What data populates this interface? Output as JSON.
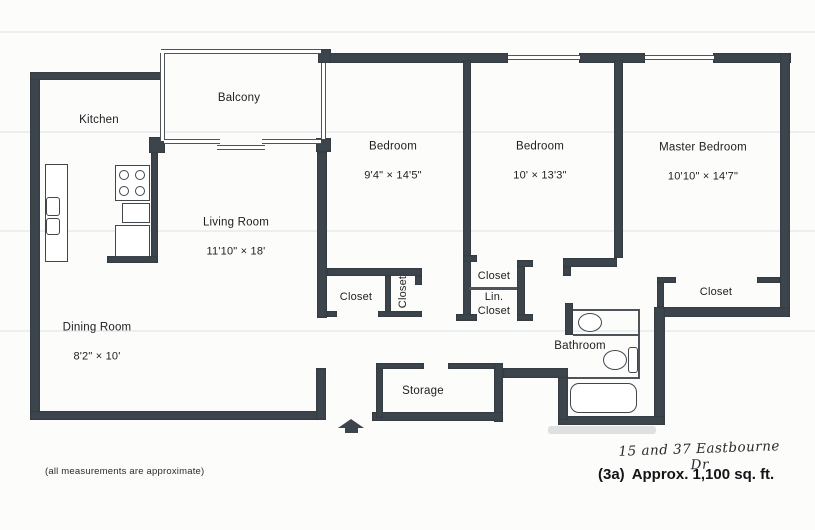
{
  "colors": {
    "wall": "#3d454c",
    "line": "#4e545a",
    "fixture": "#41464c",
    "text": "#1d1e20",
    "paper": "#fcfcfb"
  },
  "rooms": {
    "kitchen": {
      "name": "Kitchen"
    },
    "balcony": {
      "name": "Balcony"
    },
    "living_room": {
      "name": "Living Room",
      "dims": "11'10\" × 18'"
    },
    "dining_room": {
      "name": "Dining Room",
      "dims": "8'2\" × 10'"
    },
    "bedroom1": {
      "name": "Bedroom",
      "dims": "9'4\" × 14'5\""
    },
    "bedroom2": {
      "name": "Bedroom",
      "dims": "10' × 13'3\""
    },
    "master_bedroom": {
      "name": "Master Bedroom",
      "dims": "10'10\" × 14'7\""
    },
    "bathroom": {
      "name": "Bathroom"
    },
    "storage": {
      "name": "Storage"
    },
    "closet_living": {
      "name": "Closet"
    },
    "closet_bedroom1": {
      "name": "Closet"
    },
    "closet_bedroom2": {
      "name": "Closet"
    },
    "linen_closet": {
      "name": "Lin.\nCloset"
    },
    "closet_master": {
      "name": "Closet"
    }
  },
  "footer": {
    "note": "(all measurements are approximate)",
    "plan_id": "(3a)",
    "area": "Approx. 1,100 sq. ft.",
    "handwritten": "15 and 37 Eastbourne Dr"
  }
}
